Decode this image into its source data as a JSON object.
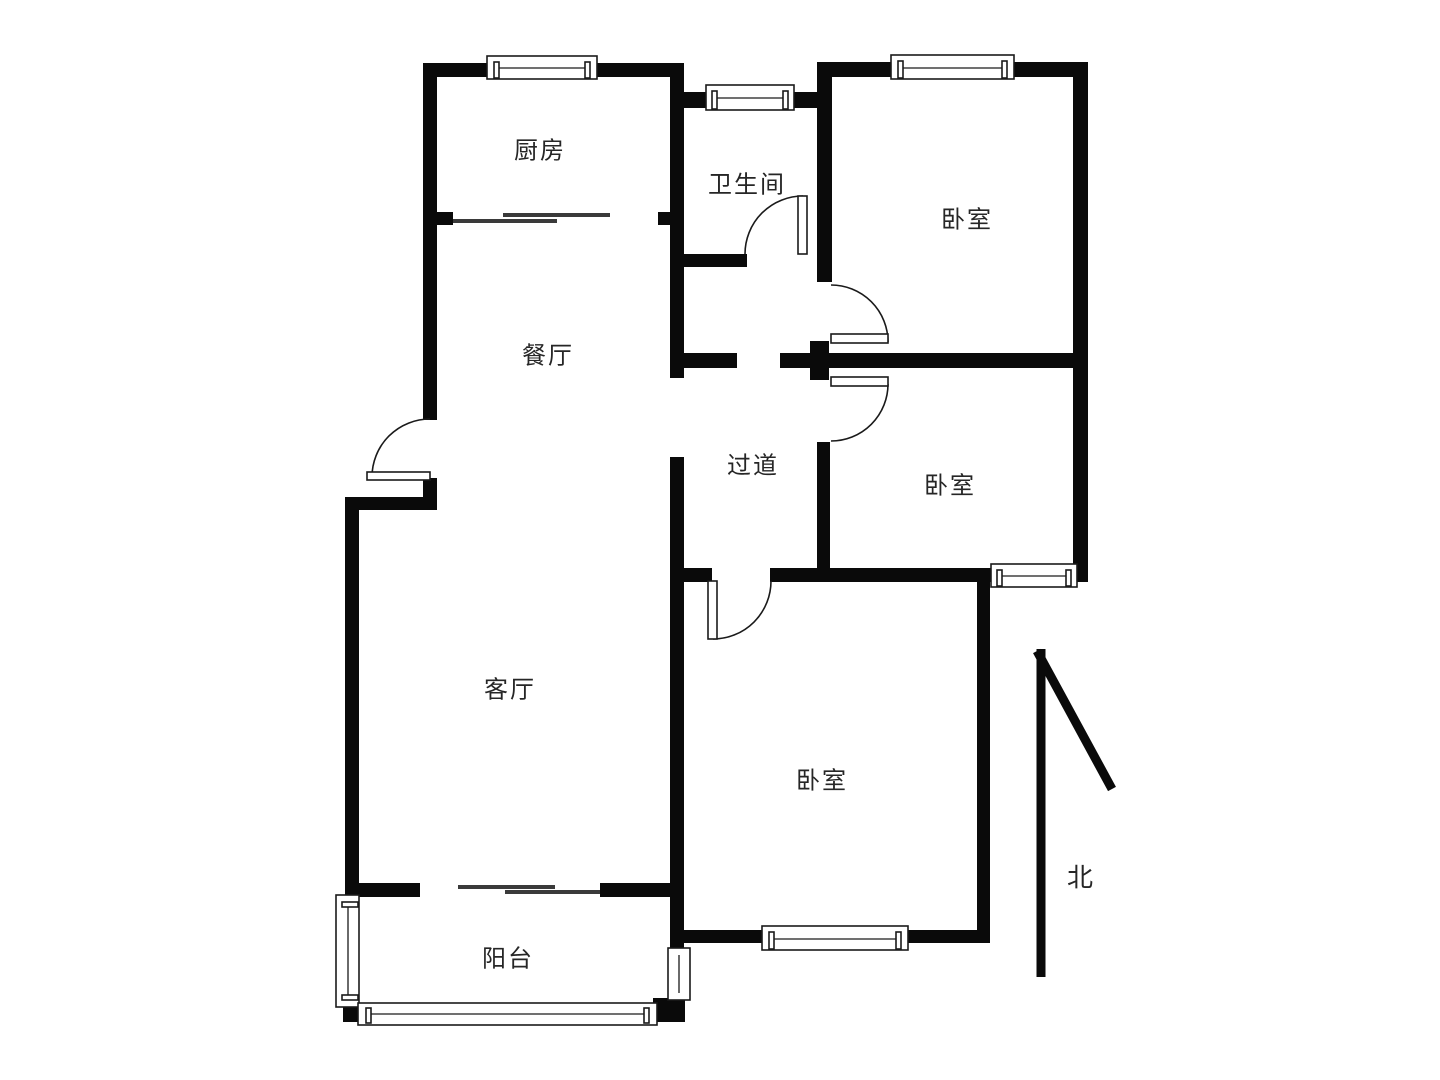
{
  "floorplan": {
    "rooms": [
      {
        "id": "kitchen",
        "label": "厨房"
      },
      {
        "id": "bathroom",
        "label": "卫生间"
      },
      {
        "id": "bedroom-top",
        "label": "卧室"
      },
      {
        "id": "dining",
        "label": "餐厅"
      },
      {
        "id": "hallway",
        "label": "过道"
      },
      {
        "id": "bedroom-middle",
        "label": "卧室"
      },
      {
        "id": "living",
        "label": "客厅"
      },
      {
        "id": "bedroom-bottom",
        "label": "卧室"
      },
      {
        "id": "balcony",
        "label": "阳台"
      }
    ],
    "compass": {
      "label": "北"
    },
    "colors": {
      "wall": "#0a0a0a",
      "text": "#262626",
      "background": "#ffffff"
    }
  }
}
